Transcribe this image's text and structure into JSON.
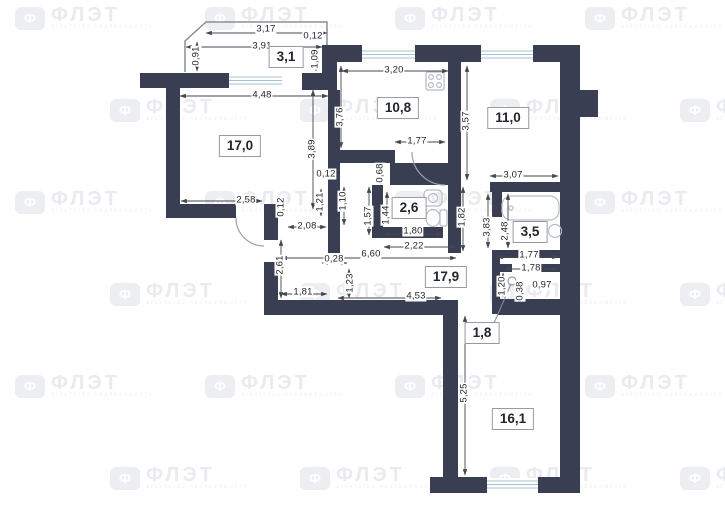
{
  "watermark": {
    "symbol": "Ф",
    "brand": "ФЛЭТ",
    "subtitle": "агентство недвижимости"
  },
  "floor_plan": {
    "rooms": [
      {
        "id": "room-balcony",
        "area": "3,1",
        "x": 286,
        "y": 57
      },
      {
        "id": "room-living",
        "area": "17,0",
        "x": 240,
        "y": 146
      },
      {
        "id": "room-kitchen",
        "area": "10,8",
        "x": 398,
        "y": 108
      },
      {
        "id": "room-bedroom-1",
        "area": "11,0",
        "x": 508,
        "y": 118
      },
      {
        "id": "room-wc",
        "area": "2,6",
        "x": 409,
        "y": 208
      },
      {
        "id": "room-bathroom",
        "area": "3,5",
        "x": 530,
        "y": 232
      },
      {
        "id": "room-hallway",
        "area": "17,9",
        "x": 446,
        "y": 277
      },
      {
        "id": "room-storage",
        "area": "1,8",
        "x": 482,
        "y": 333
      },
      {
        "id": "room-bedroom-2",
        "area": "16,1",
        "x": 513,
        "y": 419
      }
    ],
    "dimensions": [
      {
        "text": "3,17",
        "x": 266,
        "y": 29,
        "vertical": false
      },
      {
        "text": "0,12",
        "x": 313,
        "y": 36,
        "vertical": false
      },
      {
        "text": "3,91",
        "x": 262,
        "y": 46,
        "vertical": false
      },
      {
        "text": "0,91",
        "x": 196,
        "y": 56,
        "vertical": true
      },
      {
        "text": "1,09",
        "x": 315,
        "y": 59,
        "vertical": true
      },
      {
        "text": "4,48",
        "x": 262,
        "y": 95,
        "vertical": false
      },
      {
        "text": "3,20",
        "x": 394,
        "y": 70,
        "vertical": false
      },
      {
        "text": "3,76",
        "x": 340,
        "y": 117,
        "vertical": true
      },
      {
        "text": "3,57",
        "x": 466,
        "y": 121,
        "vertical": true
      },
      {
        "text": "3,07",
        "x": 513,
        "y": 175,
        "vertical": false
      },
      {
        "text": "1,77",
        "x": 417,
        "y": 141,
        "vertical": false
      },
      {
        "text": "0,68",
        "x": 380,
        "y": 173,
        "vertical": true
      },
      {
        "text": "3,89",
        "x": 312,
        "y": 149,
        "vertical": true
      },
      {
        "text": "0,12",
        "x": 326,
        "y": 174,
        "vertical": false
      },
      {
        "text": "1,21",
        "x": 320,
        "y": 202,
        "vertical": true
      },
      {
        "text": "1,10",
        "x": 343,
        "y": 201,
        "vertical": true
      },
      {
        "text": "2,58",
        "x": 246,
        "y": 200,
        "vertical": false
      },
      {
        "text": "0,12",
        "x": 281,
        "y": 207,
        "vertical": true
      },
      {
        "text": "2,08",
        "x": 307,
        "y": 226,
        "vertical": false
      },
      {
        "text": "1,57",
        "x": 368,
        "y": 216,
        "vertical": true
      },
      {
        "text": "1,44",
        "x": 386,
        "y": 215,
        "vertical": true
      },
      {
        "text": "1,82",
        "x": 462,
        "y": 217,
        "vertical": true
      },
      {
        "text": "1,80",
        "x": 413,
        "y": 231,
        "vertical": false
      },
      {
        "text": "2,22",
        "x": 414,
        "y": 246,
        "vertical": false
      },
      {
        "text": "6,60",
        "x": 371,
        "y": 254,
        "vertical": false
      },
      {
        "text": "2,61",
        "x": 280,
        "y": 265,
        "vertical": true
      },
      {
        "text": "0,28",
        "x": 334,
        "y": 259,
        "vertical": false
      },
      {
        "text": "1,23",
        "x": 350,
        "y": 283,
        "vertical": true
      },
      {
        "text": "1,81",
        "x": 303,
        "y": 292,
        "vertical": false
      },
      {
        "text": "4,53",
        "x": 416,
        "y": 296,
        "vertical": false
      },
      {
        "text": "3,83",
        "x": 487,
        "y": 227,
        "vertical": true
      },
      {
        "text": "2,48",
        "x": 505,
        "y": 231,
        "vertical": true
      },
      {
        "text": "1,77",
        "x": 529,
        "y": 255,
        "vertical": false
      },
      {
        "text": "1,78",
        "x": 531,
        "y": 268,
        "vertical": false
      },
      {
        "text": "1,20",
        "x": 502,
        "y": 286,
        "vertical": true
      },
      {
        "text": "0,38",
        "x": 520,
        "y": 291,
        "vertical": true
      },
      {
        "text": "0,97",
        "x": 542,
        "y": 285,
        "vertical": false
      },
      {
        "text": "5,25",
        "x": 464,
        "y": 393,
        "vertical": true
      }
    ]
  }
}
